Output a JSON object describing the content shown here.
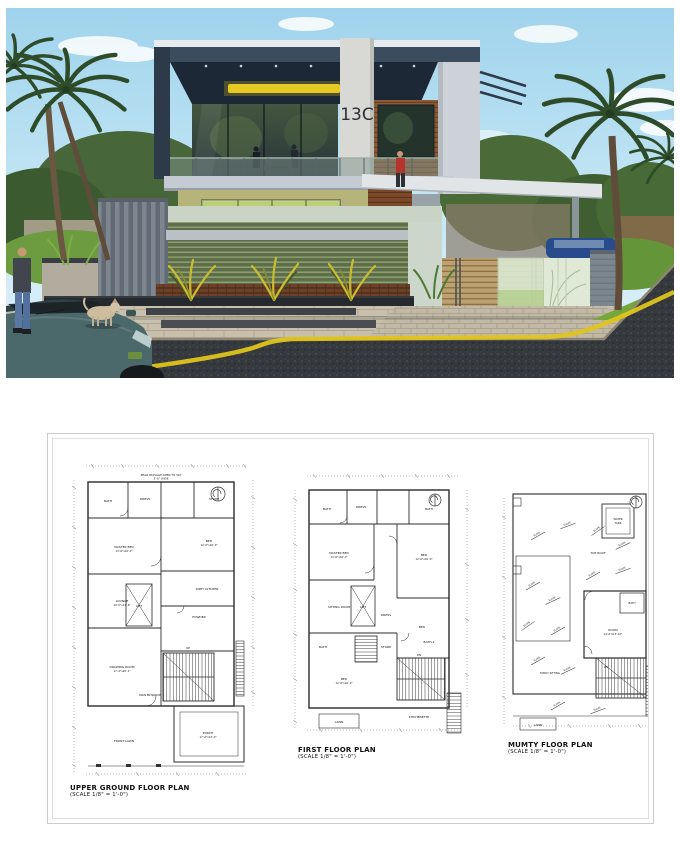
{
  "render": {
    "house_number": "13C"
  },
  "colors": {
    "yellow_line": "#dfc41c",
    "soffit_light": "#e8c822"
  },
  "plans": {
    "p1": {
      "title": "UPPER GROUND FLOOR PLAN",
      "scale": "(SCALE 1/8\" = 1'-0\")",
      "note_line1": "REAR PASSAGE OPEN TO SKY",
      "note_line2": "3'-0\" WIDE",
      "labels": {
        "bath": "BATH",
        "dress": "DRESS",
        "store": "STORE",
        "master": "MASTER BED",
        "master_dim": "13'-6\"x16'-0\"",
        "bed": "BED",
        "bed_dim": "12'-0\"x16'-0\"",
        "kitchen": "DIRTY KITCHEN",
        "powder": "POWDER",
        "lounge": "LOUNGE",
        "lounge_dim": "20'-0\"x17'-6\"",
        "lift": "LIFT",
        "up": "UP",
        "drawing": "DRAWING ROOM",
        "drawing_dim": "17'-2\"x20'-1\"",
        "entrance": "MAIN ENTRANCE",
        "porch": "PORCH",
        "porch_dim": "17'-0\"x13'-0\"",
        "lawn": "FRONT LAWN"
      }
    },
    "p2": {
      "title": "FIRST FLOOR PLAN",
      "scale": "(SCALE 1/8\" = 1'-0\")",
      "labels": {
        "bath": "BATH",
        "dress": "DRESS",
        "master": "MASTER BED",
        "master_dim": "13'-6\"x16'-0\"",
        "bed": "BED",
        "bed_dim": "12'-0\"x16'-0\"",
        "sitting": "SITTING ROOM",
        "lift": "LIFT",
        "store": "STORE",
        "bath2": "BATH-2",
        "kitchen": "KITCHENETTE",
        "dn": "DN",
        "lawn": "LAWN"
      }
    },
    "p3": {
      "title": "MUMTY FLOOR PLAN",
      "scale": "(SCALE 1/8\" = 1'-0\")",
      "labels": {
        "room": "ROOM",
        "room_dim": "14'-6\"x13'-10\"",
        "bath": "BATH",
        "tank1": "WATER",
        "tank2": "TANK",
        "roof": "TOP ROOF",
        "family": "FAMILY SITTING",
        "slope": "SLOPE",
        "dn": "DN",
        "lawn": "LAWN"
      }
    }
  }
}
